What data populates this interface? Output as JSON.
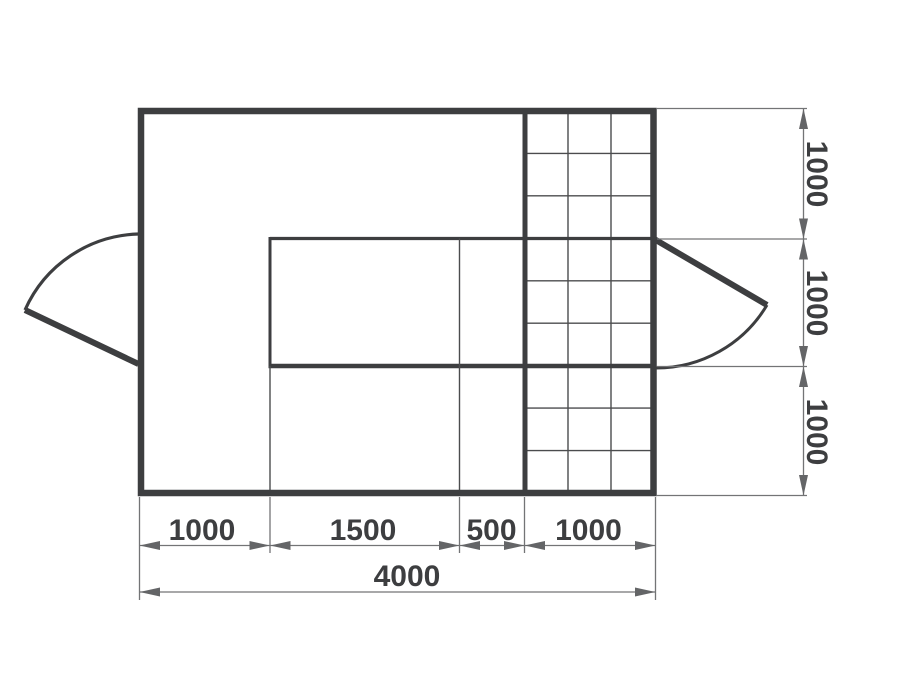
{
  "page": {
    "type": "architectural floor plan drawing",
    "background": "#ffffff"
  },
  "colors": {
    "wall": "#3d3e40",
    "grid_line": "#4b4c4e",
    "dimension_line": "#737476",
    "arrow": "#646567",
    "text": "#3d3e40"
  },
  "plan": {
    "room_width_mm": 4000,
    "room_depth_mm": 3000,
    "features": [
      "left swing door",
      "right swing door",
      "tiled grid area",
      "inner partition rectangle"
    ]
  },
  "dimensions": {
    "bottom": {
      "segments": [
        "1000",
        "1500",
        "500",
        "1000"
      ],
      "total": "4000"
    },
    "right": {
      "segments": [
        "1000",
        "1000",
        "1000"
      ]
    }
  }
}
